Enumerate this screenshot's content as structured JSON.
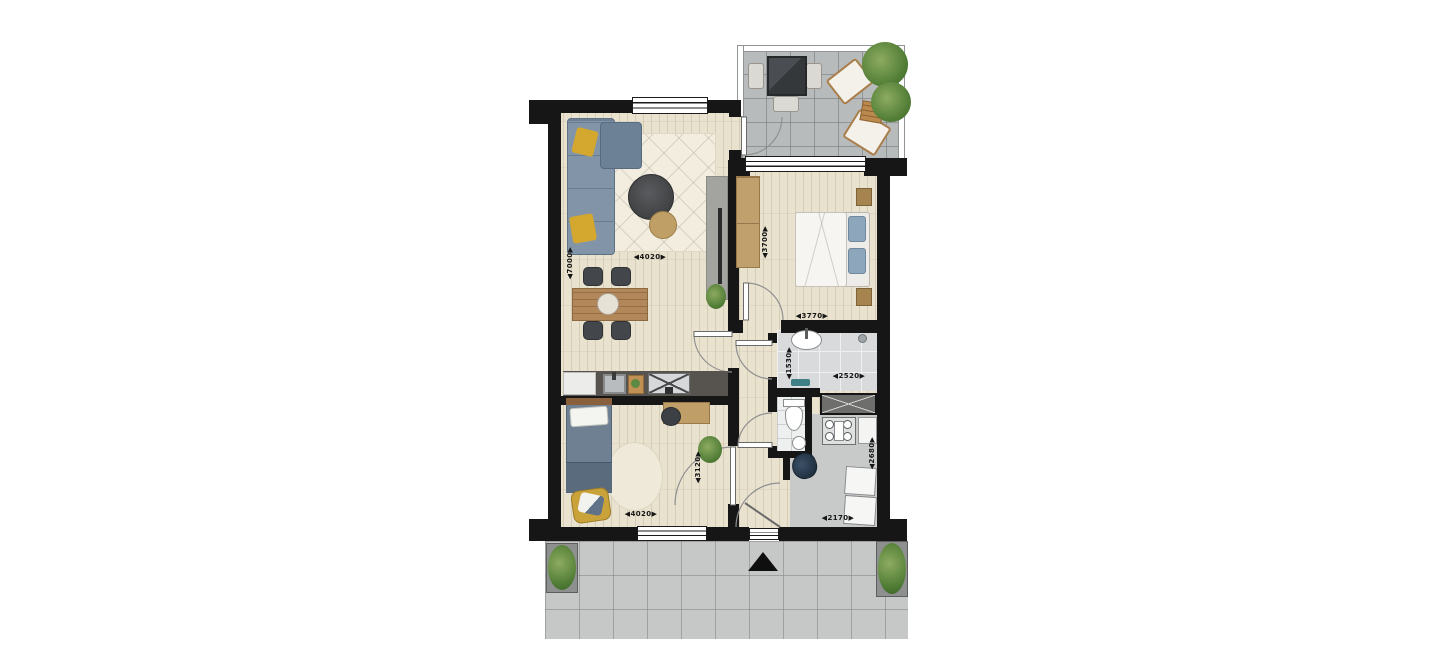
{
  "plan": {
    "type": "apartment-floorplan",
    "dims": {
      "living_height": "◀7000▶",
      "living_width": "◀4020▶",
      "bedroom1_height": "◀3700▶",
      "bedroom1_width": "◀3770▶",
      "bathroom_height": "◀1530▶",
      "bathroom_width": "◀2520▶",
      "bedroom2_height": "◀3120▶",
      "bedroom2_width": "◀4020▶",
      "storage_height": "◀2680▶",
      "storage_width": "◀2170▶"
    },
    "markers": {
      "entrance": ""
    },
    "colors": {
      "wall": "#161616",
      "wood_floor": "#e8e2cf",
      "balcony_tile": "#b8bbbc",
      "walkway_tile": "#c6c8c7",
      "bath_tile": "#d8dadc",
      "sofa_blue": "#8295a8",
      "pillow_yellow": "#d4a72f",
      "wood_furniture": "#b2875a",
      "plant_green": "#5d8a43",
      "counter_dark": "#57544f",
      "bathmat_teal": "#3f7f86"
    }
  }
}
